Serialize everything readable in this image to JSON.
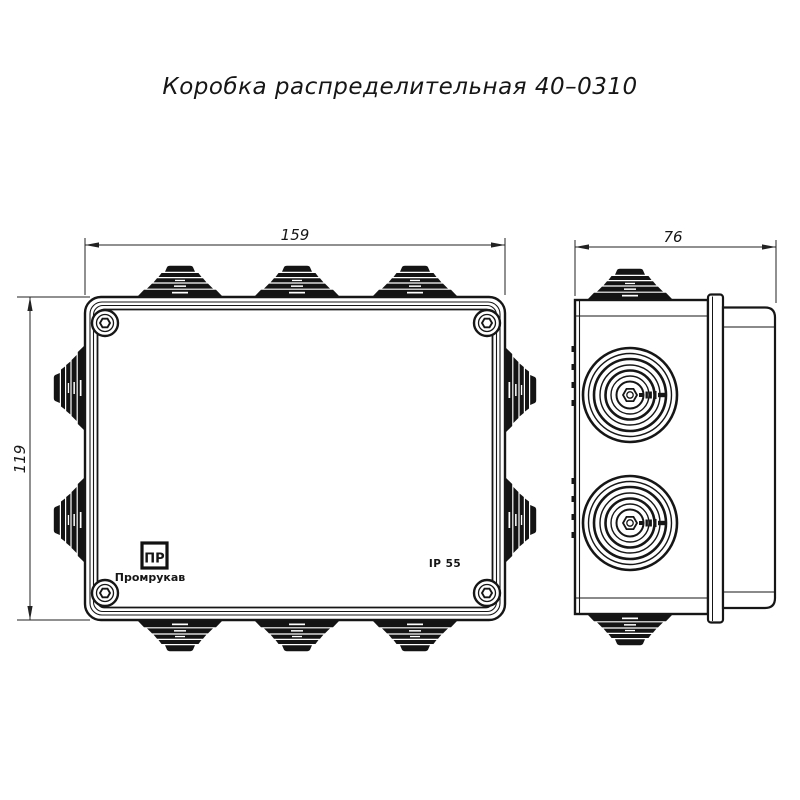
{
  "page": {
    "background": "#ffffff"
  },
  "drawing": {
    "title": "Коробка распределительная 40–0310",
    "dimensions": {
      "width_mm": "159",
      "height_mm": "119",
      "depth_mm": "76"
    },
    "markings": {
      "logo_monogram": "ПР",
      "brand": "Промрукав",
      "ip_rating": "IP 55"
    },
    "colors": {
      "line": "#161616",
      "background": "#ffffff"
    }
  }
}
